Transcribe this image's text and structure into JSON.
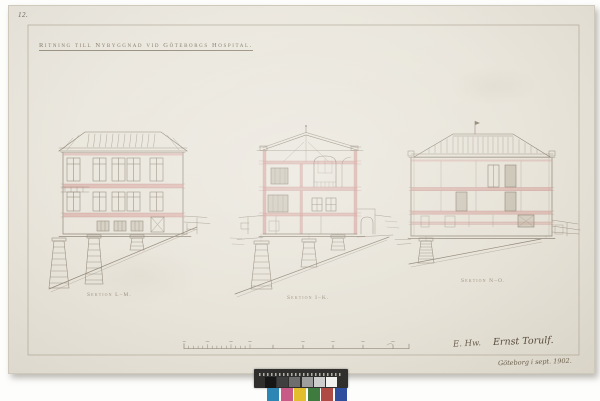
{
  "page": {
    "corner_mark": "12.",
    "title": "Ritning till Nybyggnad vid Göteborgs Hospital.",
    "sections": [
      {
        "label": "Sektion L–M."
      },
      {
        "label": "Sektion I–K."
      },
      {
        "label": "Sektion N–O."
      }
    ],
    "signature": {
      "initials": "E. Hw.",
      "name": "Ernst Torulf.",
      "dateline": "Göteborg i sept. 1902."
    }
  },
  "palette": {
    "background": "#ffffff",
    "paper": "#e9e5db",
    "ink": "#93897a",
    "ink_dark": "#7c7264",
    "masonry_pink": "#d8a8a2",
    "frame_line": "#a79d8b"
  },
  "color_target": {
    "name": "color-calibration-strip",
    "body": "#302f2d",
    "grayscale": [
      "#161616",
      "#3f3f3f",
      "#6e6e6e",
      "#9e9e9e",
      "#cdcdcd",
      "#f1f1ef"
    ],
    "colors": [
      "#2e86b5",
      "#c75a87",
      "#e2bd2e",
      "#3f7a3f",
      "#b04a44",
      "#2f4e9e"
    ]
  }
}
